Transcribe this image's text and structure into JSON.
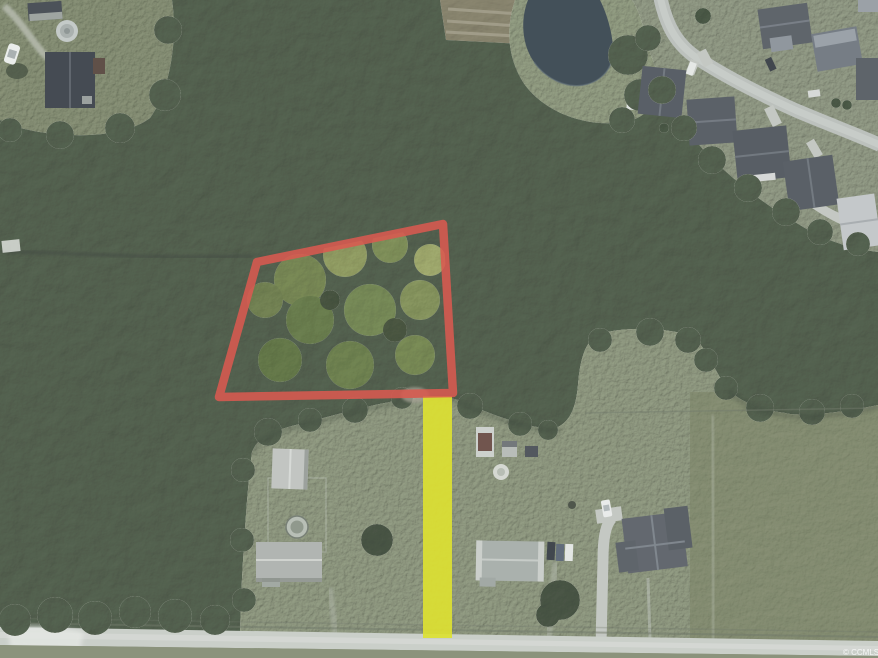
{
  "scene": {
    "title": "Aerial parcel view with boundary and access strip overlays",
    "watermark": "© CCMLS",
    "watermark_color": "#ffffff"
  },
  "overlays": {
    "parcel": {
      "points": "257,262 443,224 453,393 219,397",
      "color": "#dc544a",
      "stroke_width": "8.5",
      "opacity": "0.88"
    },
    "access_strip": {
      "x": "423",
      "y": "396",
      "width": "29",
      "height": "242",
      "color": "#dfe32a",
      "opacity": "0.92"
    }
  },
  "palette": {
    "forest": "#5c6959",
    "lawn": "#99a18c",
    "subdivision_lawn": "#9aa190",
    "pond": "#3e4a54",
    "dirt_field": "#97907d",
    "road": "#ccd0ca",
    "street": "#bdc1bd",
    "roof_dark": "#575c63",
    "roof_light": "#b2b5b1",
    "bright_canopy": "#a3b170"
  }
}
